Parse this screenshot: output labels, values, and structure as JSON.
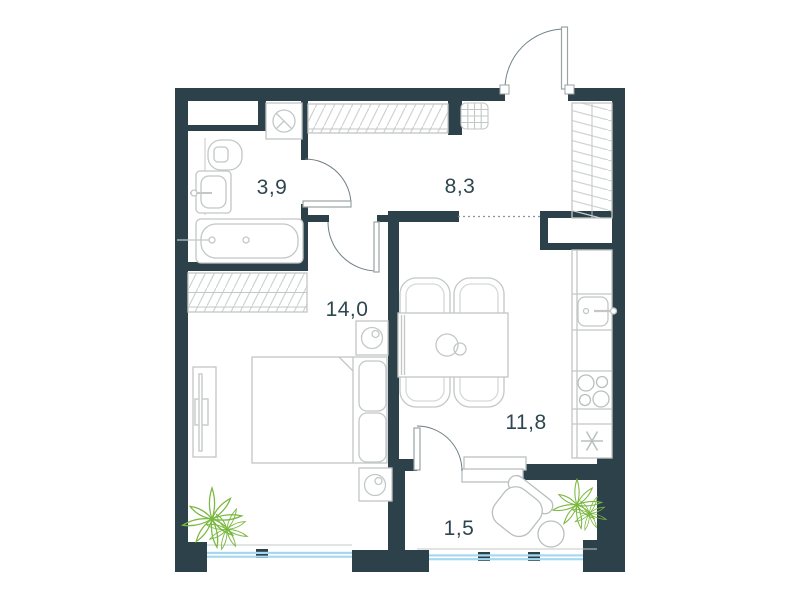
{
  "floorplan": {
    "type": "apartment-floor-plan",
    "rooms": [
      {
        "id": "bathroom",
        "area": "3,9"
      },
      {
        "id": "hallway",
        "area": "8,3"
      },
      {
        "id": "bedroom",
        "area": "14,0"
      },
      {
        "id": "kitchen-living-room",
        "area": "11,8"
      },
      {
        "id": "balcony",
        "area": "1,5"
      }
    ],
    "colors": {
      "wall": "#2c4149",
      "label_text": "#2e4650",
      "furniture_outline": "#c3c7c7",
      "door_arc": "#6e8086",
      "window_glazing": "#a6d9f0",
      "plant_green": "#7ab840",
      "hatch_line": "#d0d3d3"
    }
  }
}
